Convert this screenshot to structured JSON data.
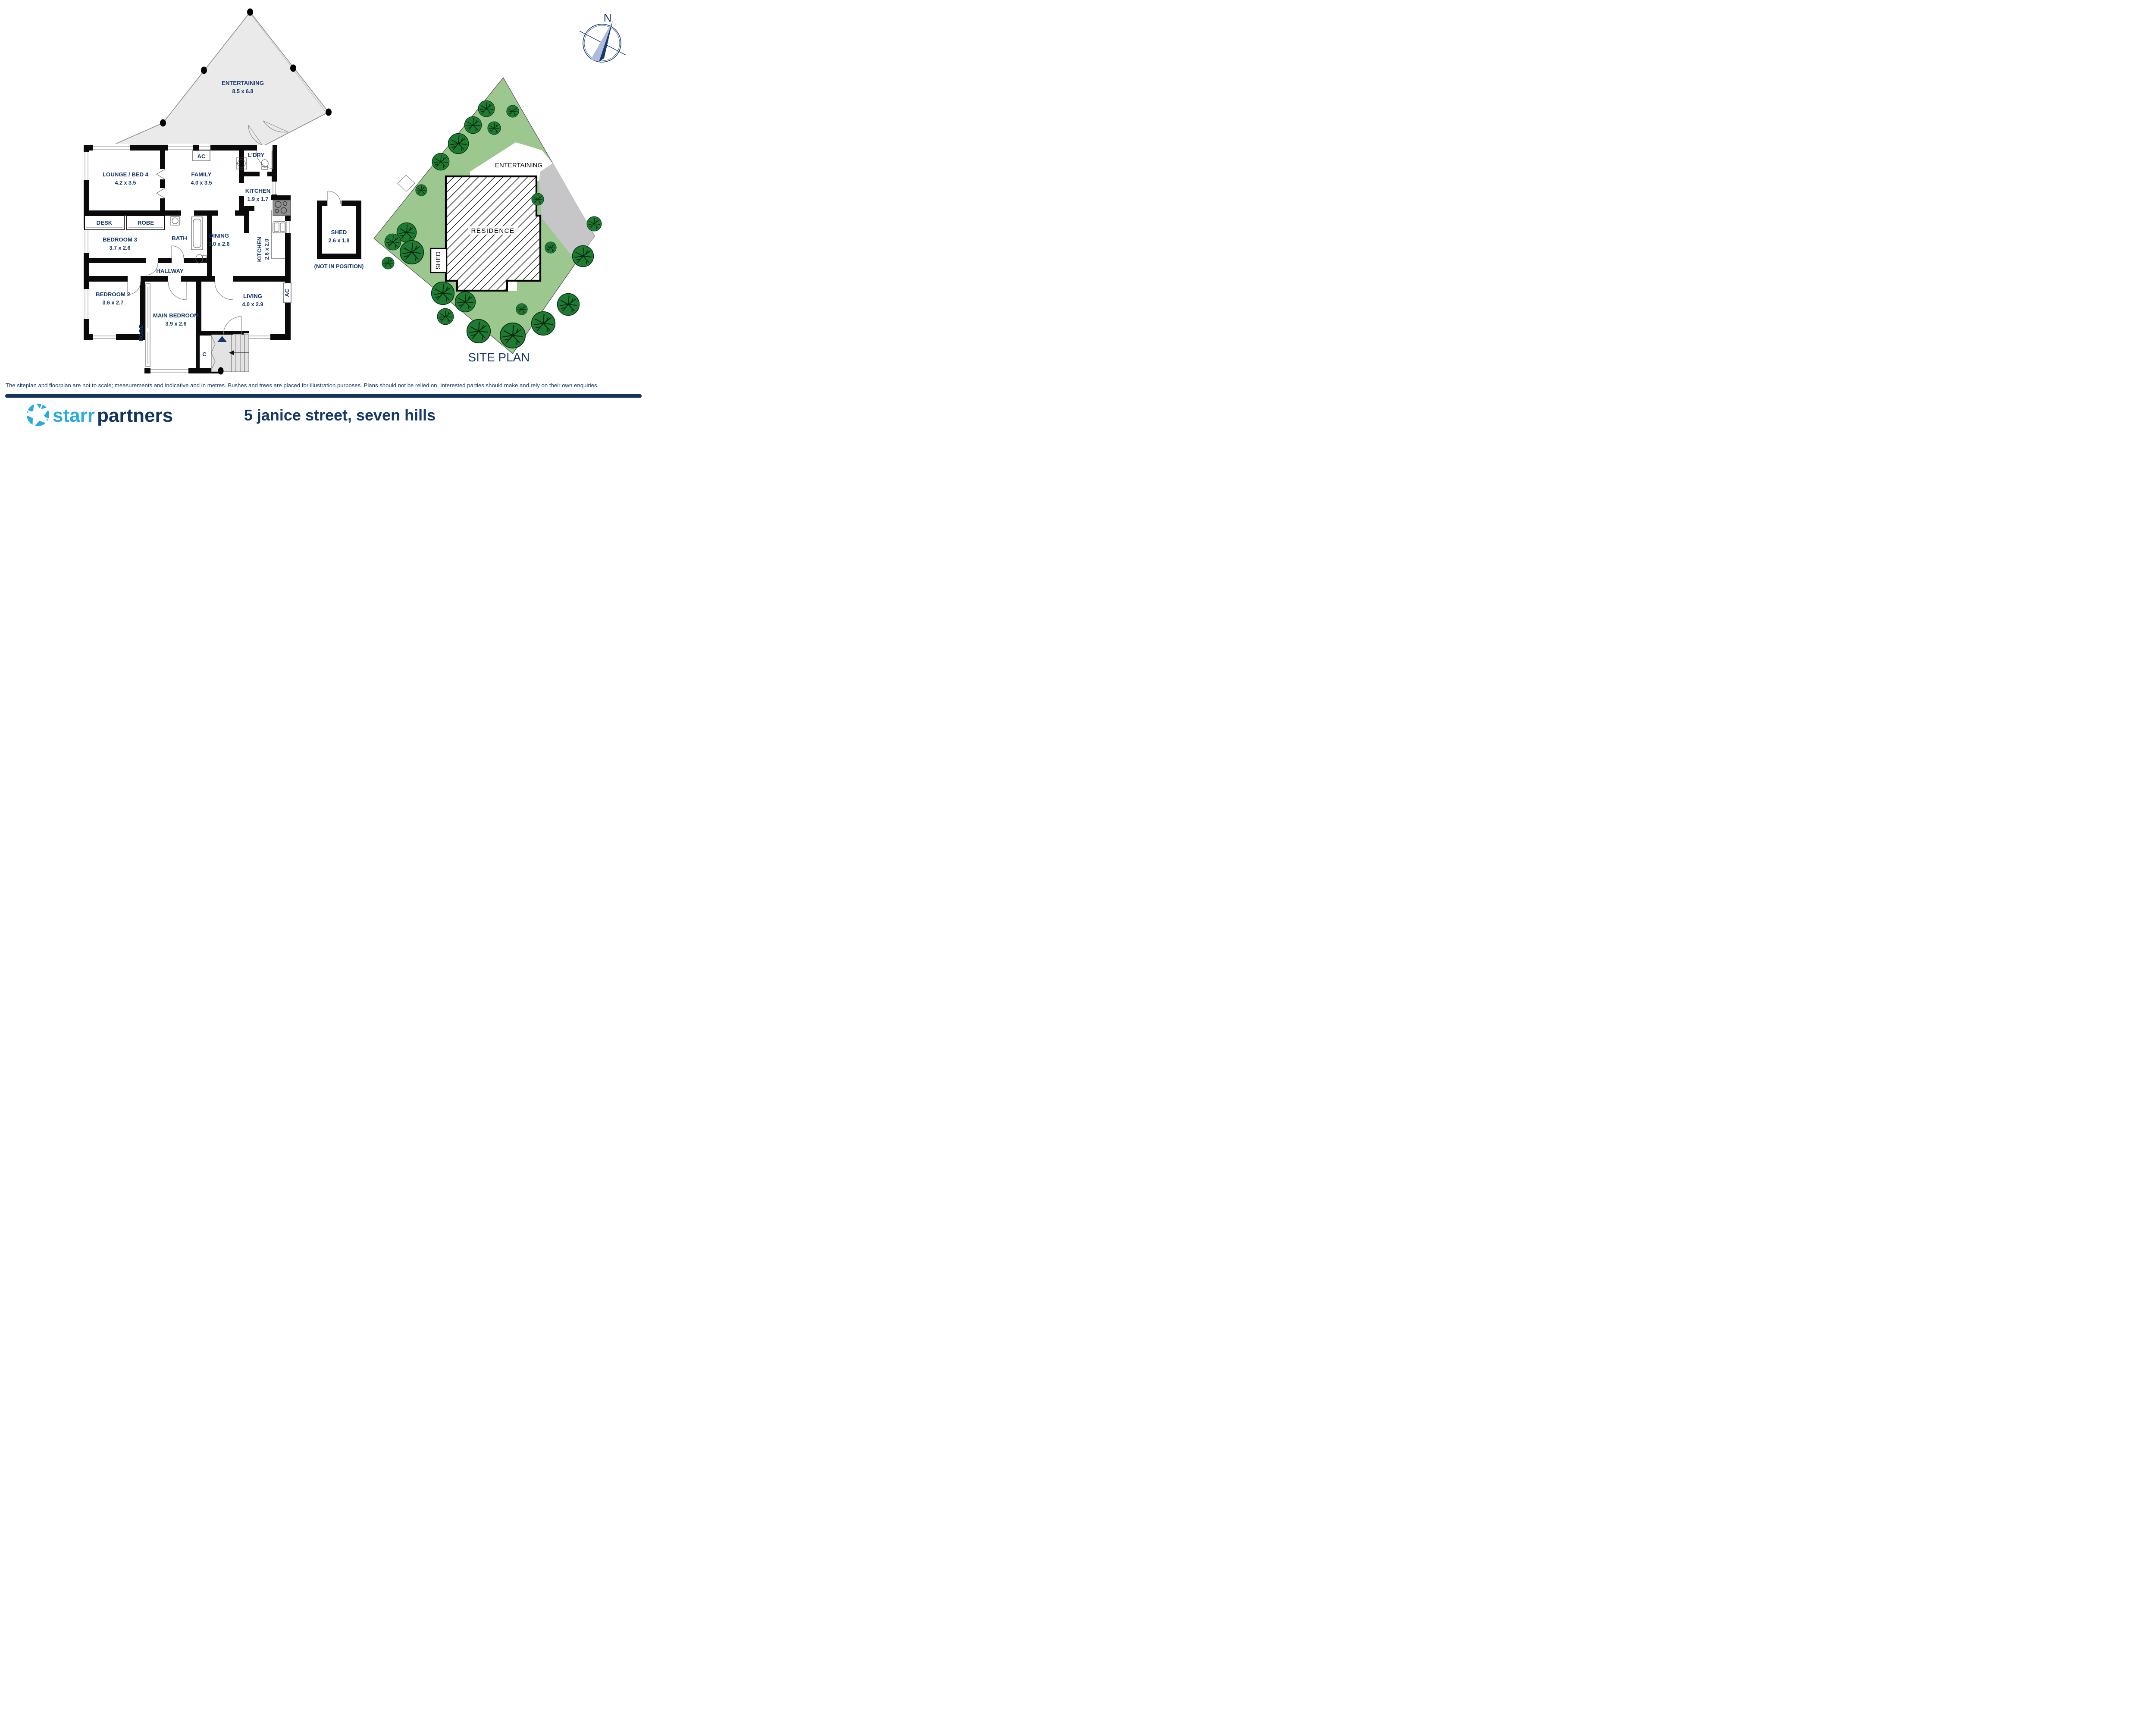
{
  "colors": {
    "label_navy": "#17386B",
    "brand_blue": "#29ABE2",
    "brand_navy": "#14355F",
    "bar_navy": "#14335C",
    "lot_green": "#9CC78F",
    "tree_green": "#1F7A33",
    "driveway_gray": "#C6C6C8",
    "deck_gray": "#EAEAEB",
    "wall_black": "#0a0a0a"
  },
  "floorplan": {
    "deck": {
      "name": "ENTERTAINING",
      "dims": "8.5 x 6.8"
    },
    "rooms": {
      "lounge": {
        "name": "LOUNGE / BED 4",
        "dims": "4.2 x 3.5"
      },
      "family": {
        "name": "FAMILY",
        "dims": "4.0 x 3.5"
      },
      "laundry": {
        "name": "L'DRY"
      },
      "kitchen": {
        "name": "KITCHEN",
        "dims": "1.9 x 1.7"
      },
      "desk": {
        "name": "DESK"
      },
      "robe": {
        "name": "ROBE"
      },
      "bedroom3": {
        "name": "BEDROOM 3",
        "dims": "3.7 x 2.6"
      },
      "bath": {
        "name": "BATH"
      },
      "dining": {
        "name": "DINING",
        "dims": "3.0 x 2.6"
      },
      "kitchen2": {
        "name": "KITCHEN",
        "dims": "2.6 x 2.0"
      },
      "hallway": {
        "name": "HALLWAY"
      },
      "bedroom2": {
        "name": "BEDROOM 2",
        "dims": "3.6 x 2.7"
      },
      "robe2": {
        "name": "ROBE"
      },
      "main_bedroom": {
        "name": "MAIN BEDROOM",
        "dims": "3.9 x 2.6"
      },
      "living": {
        "name": "LIVING",
        "dims": "4.0 x 2.9"
      },
      "closet": {
        "name": "C"
      }
    },
    "shed": {
      "name": "SHED",
      "dims": "2.6 x 1.8",
      "note": "(NOT IN POSITION)"
    },
    "ac_top": "AC",
    "ac_right": "AC"
  },
  "siteplan": {
    "title": "SITE PLAN",
    "residence": "RESIDENCE",
    "entertaining": "ENTERTAINING",
    "shed": "SHED"
  },
  "compass": {
    "label": "N"
  },
  "footer": {
    "disclaimer": "The siteplan and floorplan are not to scale; measurements and indicative and in metres. Bushes and trees are placed for illustration purposes. Plans should not be relied on. Interested parties should make and rely on their own enquiries.",
    "brand": {
      "first": "starr",
      "second": "partners"
    },
    "address": "5 janice street, seven hills"
  }
}
